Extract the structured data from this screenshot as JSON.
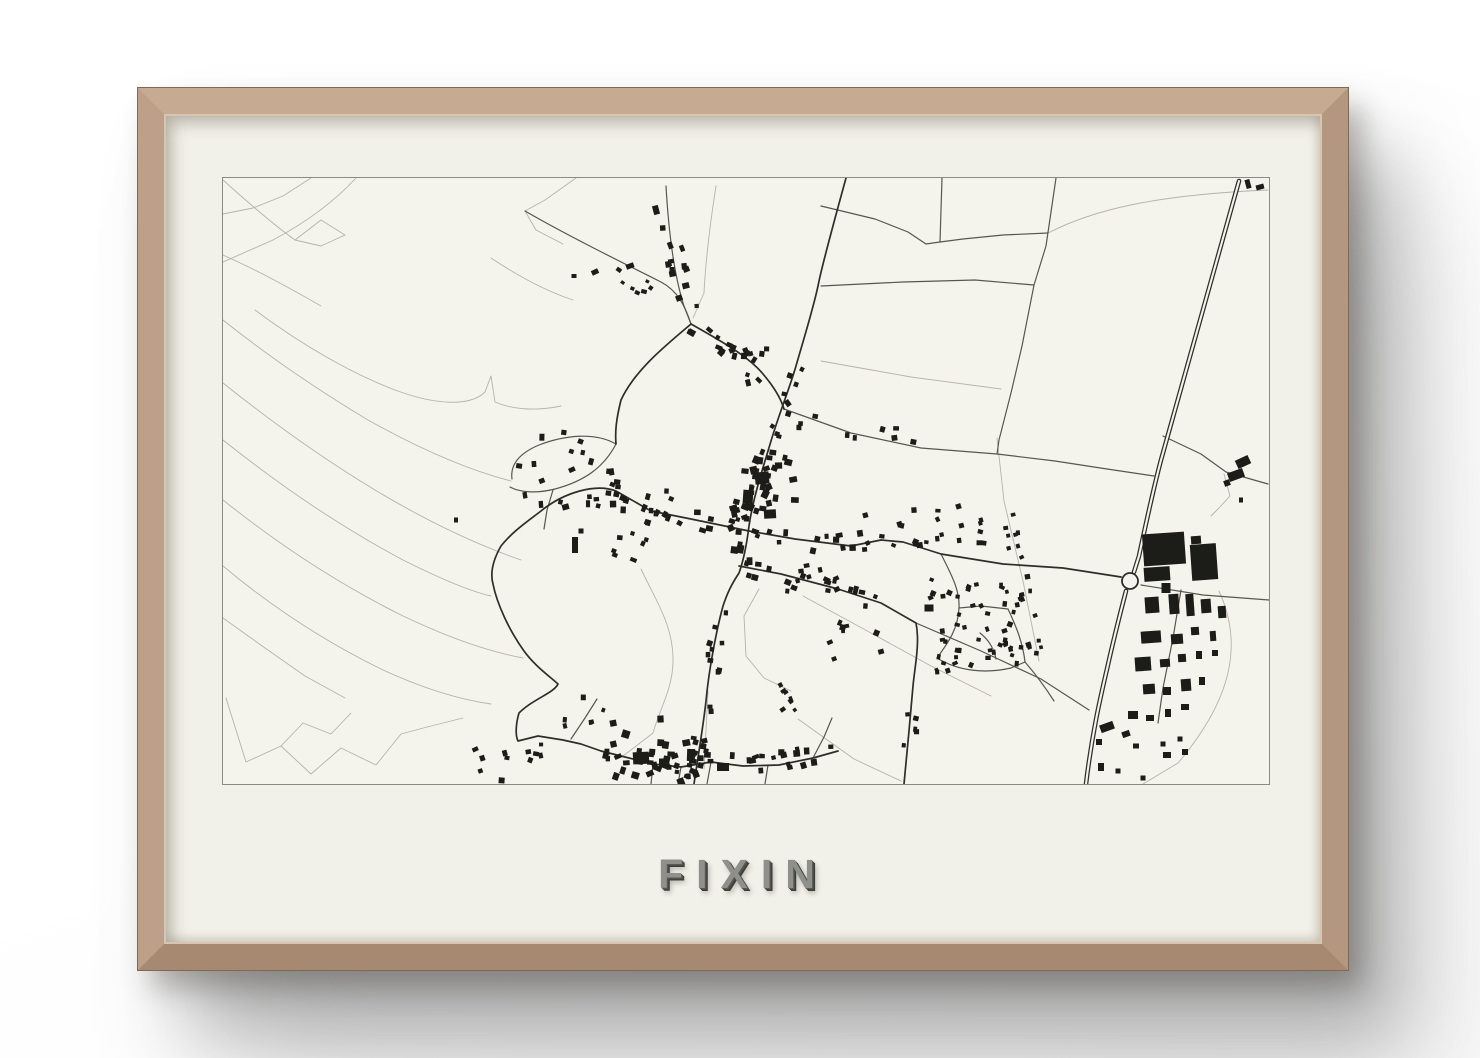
{
  "poster": {
    "title": "FIXIN"
  },
  "colors": {
    "wall": "#ffffff",
    "wood": "#b79a82",
    "paper": "#f2f1e9",
    "map_bg": "#f4f3ec",
    "map_border": "#8b8a83",
    "field_line": "#b5b3ab",
    "minor_road": "#57564f",
    "major_road": "#2e2d29",
    "building": "#1c1c19",
    "title_face": "#8f8f8c",
    "title_shadow": "#3e3e39"
  },
  "map": {
    "viewbox": "0 0 1046 606",
    "width": 1046,
    "height": 606,
    "field_paths": [
      "M133,0 C110,25 82,45 50,62 L0,84",
      "M0,2 C20,20 48,45 72,62",
      "M72,62 L98,42 122,57 98,68 72,62",
      "M0,77 C40,95 70,112 98,128",
      "M32,132 C80,168 130,196 172,212 C215,228 248,228 262,214 L268,198 272,224 C290,232 315,233 338,228",
      "M0,142 C45,178 95,212 145,242 C195,270 245,292 288,303",
      "M0,205 C50,245 102,282 152,312 C202,342 252,366 298,382",
      "M0,262 C60,310 120,350 180,382 C220,402 250,414 268,418",
      "M0,322 C60,370 120,408 178,437 C228,461 268,474 300,480",
      "M0,388 C50,430 105,465 158,491 C203,512 240,522 268,526",
      "M3,520 L23,584 58,568 88,596 118,570 153,587 178,556 208,548 240,540",
      "M58,568 L80,545 108,556 128,535",
      "M353,0 L322,22 302,33 313,52 340,66",
      "M493,8 C488,40 483,75 481,115 L470,140",
      "M598,183 L688,199 778,211",
      "M825,55 C870,32 930,17 1045,12",
      "M774,260 L781,323 800,403 816,483",
      "M996,413 C1020,465 1010,520 955,585 L920,606",
      "M418,391 C433,423 451,448 450,485 C449,512 437,530 430,555 L400,578",
      "M536,411 L521,438 523,478 541,500 568,513",
      "M580,418 L648,455 708,488 768,518",
      "M575,541 L631,581 678,603",
      "M485,513 L481,591",
      "M268,80 C292,96 320,112 350,122",
      "M88,0 L60,18 30,30 0,36",
      "M0,440 L42,470 82,498 122,520",
      "M1001,296 L1007,318 996,330 988,338"
    ],
    "minor_paths": [
      "M302,33 C340,55 390,80 438,104 C455,113 462,128 468,146",
      "M443,8 C446,60 452,100 461,128 L468,146",
      "M598,108 L680,104 752,102 811,107",
      "M833,0 L823,68 811,107 799,168 788,215 776,262 774,276",
      "M598,28 L652,41 685,54 703,66 717,64 740,61 780,57 825,55",
      "M719,0 L717,64",
      "M561,231 L628,255 698,270 774,276 832,283 884,291 931,298",
      "M940,258 L978,276 1003,294 1045,306",
      "M918,407 L980,417 1046,422",
      "M693,445 L758,473 818,501 866,532",
      "M718,376 C728,396 737,412 736,430 C735,452 724,466 714,480",
      "M736,430 L758,428 785,431",
      "M714,480 C735,493 762,496 788,490 L802,484",
      "M785,431 C794,450 800,466 802,484",
      "M757,455 C766,462 771,471 773,481",
      "M802,484 C815,499 824,512 831,523",
      "M289,301 C287,286 297,275 316,267 C342,257 372,254 393,266",
      "M287,309 C296,314 312,316 332,311 C362,303 381,289 393,266",
      "M330,312 L324,332 321,351",
      "M488,584 L484,606",
      "M545,587 L542,606",
      "M458,589 L455,606",
      "M430,586 L428,606",
      "M348,561 L362,540 374,521",
      "M590,580 L601,559 609,540",
      "M958,412 L950,460 940,510 935,545"
    ],
    "major_paths": [
      "M623,0 C612,40 601,80 596,103 C592,125 581,160 573,188 C566,212 556,236 548,263 C540,290 530,320 526,348 C523,372 520,384 516,395 C508,407 504,416 500,428 C494,450 486,490 483,523 C480,550 474,585 471,606",
      "M468,146 C498,163 525,178 540,196 C552,210 558,221 561,231",
      "M468,146 C442,168 412,192 398,222 C393,242 392,254 393,266",
      "M526,353 L572,361 628,368 658,362 680,364 718,376 780,386 840,390 898,399",
      "M526,353 L468,341 428,333 393,313 C372,305 340,315 318,333 C305,343 290,353 278,368 C270,382 267,395 270,406 C274,426 286,452 301,473 C312,488 325,497 335,506 C331,515 310,521 296,535 C293,545 292,557 295,563 L315,558 340,562 358,566 378,573",
      "M516,388 L558,396 615,411 658,425 693,445 C697,465 692,487 690,508 L686,553 681,606",
      "M378,573 L402,579 430,586 458,589 488,584 520,588 556,587 590,580 615,573"
    ],
    "highway": {
      "d": "M1016,3 L938,282 C930,312 922,350 916,378 L911,394 M903,413 C897,436 890,464 884,491 C877,521 869,556 863,606",
      "casing_width": 4.6,
      "inner_width": 2.1
    },
    "roundabout": {
      "cx": 907,
      "cy": 403,
      "r": 8
    },
    "buildings": [
      [
        941,
        371,
        42,
        32,
        -4
      ],
      [
        934,
        396,
        26,
        14,
        -4
      ],
      [
        981,
        384,
        26,
        36,
        -4
      ],
      [
        973,
        362,
        10,
        8,
        -4
      ],
      [
        943,
        410,
        9,
        10,
        0
      ],
      [
        929,
        427,
        14,
        16,
        -4
      ],
      [
        951,
        426,
        10,
        20,
        -4
      ],
      [
        967,
        427,
        8,
        22,
        -4
      ],
      [
        983,
        428,
        10,
        14,
        -4
      ],
      [
        999,
        434,
        8,
        12,
        -4
      ],
      [
        928,
        459,
        20,
        12,
        -4
      ],
      [
        954,
        461,
        12,
        10,
        -4
      ],
      [
        972,
        453,
        8,
        8,
        -4
      ],
      [
        990,
        458,
        6,
        10,
        -4
      ],
      [
        920,
        486,
        16,
        14,
        -4
      ],
      [
        942,
        485,
        10,
        8,
        -4
      ],
      [
        959,
        480,
        8,
        8,
        -4
      ],
      [
        976,
        477,
        6,
        8,
        0
      ],
      [
        992,
        475,
        6,
        6,
        0
      ],
      [
        926,
        511,
        12,
        10,
        -4
      ],
      [
        944,
        513,
        8,
        8,
        0
      ],
      [
        963,
        507,
        10,
        12,
        -4
      ],
      [
        979,
        503,
        6,
        8,
        0
      ],
      [
        910,
        537,
        10,
        8,
        0
      ],
      [
        927,
        540,
        8,
        6,
        0
      ],
      [
        945,
        535,
        6,
        8,
        0
      ],
      [
        962,
        529,
        8,
        6,
        0
      ],
      [
        884,
        549,
        14,
        8,
        -20
      ],
      [
        903,
        556,
        8,
        6,
        -20
      ],
      [
        876,
        564,
        6,
        6,
        0
      ],
      [
        913,
        568,
        6,
        5,
        0
      ],
      [
        940,
        566,
        5,
        5,
        0
      ],
      [
        957,
        561,
        5,
        5,
        0
      ],
      [
        878,
        589,
        6,
        8,
        0
      ],
      [
        895,
        593,
        5,
        5,
        0
      ],
      [
        920,
        600,
        5,
        5,
        0
      ],
      [
        944,
        577,
        8,
        6,
        0
      ],
      [
        962,
        574,
        6,
        6,
        0
      ],
      [
        1020,
        284,
        14,
        9,
        -25
      ],
      [
        1013,
        297,
        16,
        9,
        -20
      ],
      [
        1004,
        305,
        6,
        6,
        -20
      ],
      [
        1018,
        322,
        4,
        5,
        0
      ],
      [
        1025,
        6,
        5,
        9,
        -15
      ],
      [
        1037,
        9,
        8,
        5,
        -15
      ],
      [
        539,
        300,
        14,
        12,
        -6
      ],
      [
        525,
        319,
        10,
        14,
        4
      ],
      [
        547,
        336,
        12,
        9,
        -3
      ],
      [
        352,
        367,
        6,
        16,
        0
      ],
      [
        358,
        353,
        5,
        5,
        0
      ],
      [
        233,
        342,
        4,
        5,
        0
      ],
      [
        433,
        32,
        6,
        9,
        -15
      ],
      [
        407,
        88,
        8,
        5,
        -20
      ],
      [
        449,
        92,
        5,
        6,
        0
      ],
      [
        372,
        94,
        7,
        5,
        -25
      ],
      [
        351,
        98,
        5,
        4,
        0
      ],
      [
        418,
        580,
        16,
        12,
        -3
      ],
      [
        441,
        585,
        10,
        9,
        0
      ],
      [
        468,
        577,
        8,
        12,
        2
      ],
      [
        500,
        589,
        12,
        8,
        0
      ],
      [
        706,
        430,
        9,
        7,
        0
      ]
    ],
    "clusters": [
      {
        "type": "line",
        "pts": [
          [
            445,
            40
          ],
          [
            462,
            120
          ],
          [
            468,
            146
          ]
        ],
        "count": 12,
        "spread": 16,
        "smin": 4,
        "smax": 7,
        "seed": 11
      },
      {
        "type": "line",
        "pts": [
          [
            468,
            146
          ],
          [
            540,
            196
          ],
          [
            561,
            228
          ]
        ],
        "count": 12,
        "spread": 14,
        "smin": 4,
        "smax": 7,
        "seed": 12
      },
      {
        "type": "box",
        "x": 505,
        "y": 170,
        "w": 55,
        "h": 48,
        "count": 10,
        "smin": 4,
        "smax": 7,
        "seed": 13
      },
      {
        "type": "line",
        "pts": [
          [
            390,
            96
          ],
          [
            438,
            118
          ]
        ],
        "count": 7,
        "spread": 10,
        "smin": 3,
        "smax": 6,
        "seed": 14
      },
      {
        "type": "line",
        "pts": [
          [
            573,
            188
          ],
          [
            561,
            231
          ],
          [
            548,
            258
          ]
        ],
        "count": 8,
        "spread": 10,
        "smin": 4,
        "smax": 6,
        "seed": 15
      },
      {
        "type": "line",
        "pts": [
          [
            548,
            260
          ],
          [
            526,
            348
          ],
          [
            518,
            390
          ]
        ],
        "count": 26,
        "spread": 16,
        "smin": 4,
        "smax": 8,
        "seed": 16
      },
      {
        "type": "box",
        "x": 505,
        "y": 278,
        "w": 72,
        "h": 76,
        "count": 22,
        "smin": 4,
        "smax": 8,
        "seed": 17
      },
      {
        "type": "line",
        "pts": [
          [
            398,
            316
          ],
          [
            470,
            342
          ],
          [
            524,
            352
          ]
        ],
        "count": 14,
        "spread": 12,
        "smin": 4,
        "smax": 7,
        "seed": 18
      },
      {
        "type": "box",
        "x": 390,
        "y": 296,
        "w": 66,
        "h": 92,
        "count": 18,
        "smin": 4,
        "smax": 7,
        "seed": 19
      },
      {
        "type": "line",
        "pts": [
          [
            528,
            356
          ],
          [
            600,
            366
          ],
          [
            650,
            363
          ]
        ],
        "count": 12,
        "spread": 11,
        "smin": 4,
        "smax": 7,
        "seed": 20
      },
      {
        "type": "line",
        "pts": [
          [
            520,
            390
          ],
          [
            600,
            408
          ],
          [
            655,
            424
          ]
        ],
        "count": 16,
        "spread": 11,
        "smin": 4,
        "smax": 7,
        "seed": 21
      },
      {
        "type": "box",
        "x": 560,
        "y": 386,
        "w": 80,
        "h": 34,
        "count": 9,
        "smin": 4,
        "smax": 6,
        "seed": 22
      },
      {
        "type": "line",
        "pts": [
          [
            566,
            240
          ],
          [
            640,
            254
          ],
          [
            698,
            258
          ]
        ],
        "count": 9,
        "spread": 9,
        "smin": 4,
        "smax": 6,
        "seed": 23
      },
      {
        "type": "box",
        "x": 286,
        "y": 252,
        "w": 112,
        "h": 82,
        "count": 24,
        "smin": 4,
        "smax": 7,
        "seed": 24
      },
      {
        "type": "line",
        "pts": [
          [
            500,
            430
          ],
          [
            486,
            510
          ]
        ],
        "count": 9,
        "spread": 9,
        "smin": 4,
        "smax": 6,
        "seed": 25
      },
      {
        "type": "line",
        "pts": [
          [
            483,
            520
          ],
          [
            472,
            600
          ]
        ],
        "count": 10,
        "spread": 10,
        "smin": 4,
        "smax": 6,
        "seed": 26
      },
      {
        "type": "line",
        "pts": [
          [
            548,
            497
          ],
          [
            572,
            540
          ]
        ],
        "count": 7,
        "spread": 8,
        "smin": 3,
        "smax": 6,
        "seed": 27
      },
      {
        "type": "box",
        "x": 705,
        "y": 392,
        "w": 112,
        "h": 106,
        "count": 55,
        "smin": 3.5,
        "smax": 5.5,
        "seed": 28
      },
      {
        "type": "line",
        "pts": [
          [
            781,
            325
          ],
          [
            800,
            403
          ],
          [
            815,
            480
          ]
        ],
        "count": 15,
        "spread": 8,
        "smin": 3.5,
        "smax": 5,
        "seed": 29
      },
      {
        "type": "box",
        "x": 714,
        "y": 320,
        "w": 50,
        "h": 46,
        "count": 12,
        "smin": 3.5,
        "smax": 5.5,
        "seed": 30
      },
      {
        "type": "box",
        "x": 640,
        "y": 330,
        "w": 68,
        "h": 42,
        "count": 11,
        "smin": 3.5,
        "smax": 6,
        "seed": 31
      },
      {
        "type": "line",
        "pts": [
          [
            402,
            578
          ],
          [
            520,
            588
          ],
          [
            612,
            573
          ]
        ],
        "count": 26,
        "spread": 13,
        "smin": 4,
        "smax": 7,
        "seed": 32
      },
      {
        "type": "box",
        "x": 378,
        "y": 540,
        "w": 96,
        "h": 64,
        "count": 22,
        "smin": 4,
        "smax": 8,
        "seed": 33
      },
      {
        "type": "box",
        "x": 251,
        "y": 566,
        "w": 72,
        "h": 38,
        "count": 11,
        "smin": 3.5,
        "smax": 6,
        "seed": 34
      },
      {
        "type": "box",
        "x": 330,
        "y": 518,
        "w": 52,
        "h": 30,
        "count": 6,
        "smin": 3.5,
        "smax": 6,
        "seed": 35
      },
      {
        "type": "box",
        "x": 606,
        "y": 443,
        "w": 54,
        "h": 40,
        "count": 8,
        "smin": 3.5,
        "smax": 6,
        "seed": 36
      },
      {
        "type": "box",
        "x": 430,
        "y": 555,
        "w": 60,
        "h": 44,
        "count": 10,
        "smin": 4,
        "smax": 7,
        "seed": 37
      },
      {
        "type": "line",
        "pts": [
          [
            690,
            510
          ],
          [
            686,
            570
          ]
        ],
        "count": 5,
        "spread": 8,
        "smin": 3.5,
        "smax": 5.5,
        "seed": 38
      }
    ]
  }
}
